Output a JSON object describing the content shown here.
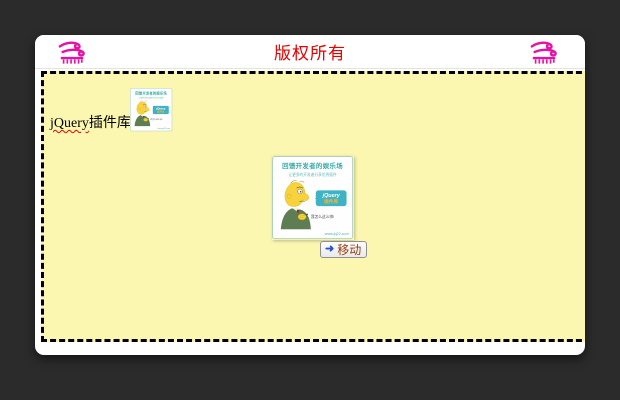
{
  "window": {
    "background": "#2b2b2b",
    "panel_color": "#ffffff"
  },
  "header": {
    "title": "版权所有",
    "title_color": "#e60000",
    "left_icon": "wind-icon",
    "right_icon": "wind-icon",
    "icon_color": "#e611a5"
  },
  "canvas": {
    "background_color": "#fbf7b0",
    "border": "3px dashed black",
    "label": {
      "en": "jQuery",
      "zh": "插件库"
    }
  },
  "promo_card": {
    "tagline": "回馈开发者的娱乐场",
    "subtitle": "让更多的开发者分享优秀插件",
    "bubble_en": "jQuery",
    "bubble_zh": "插件库",
    "note": "我怎么这么帅!",
    "site": "www.jq22.com"
  },
  "move_button": {
    "arrow": "➜",
    "label": "移动",
    "label_color": "#963c10"
  }
}
